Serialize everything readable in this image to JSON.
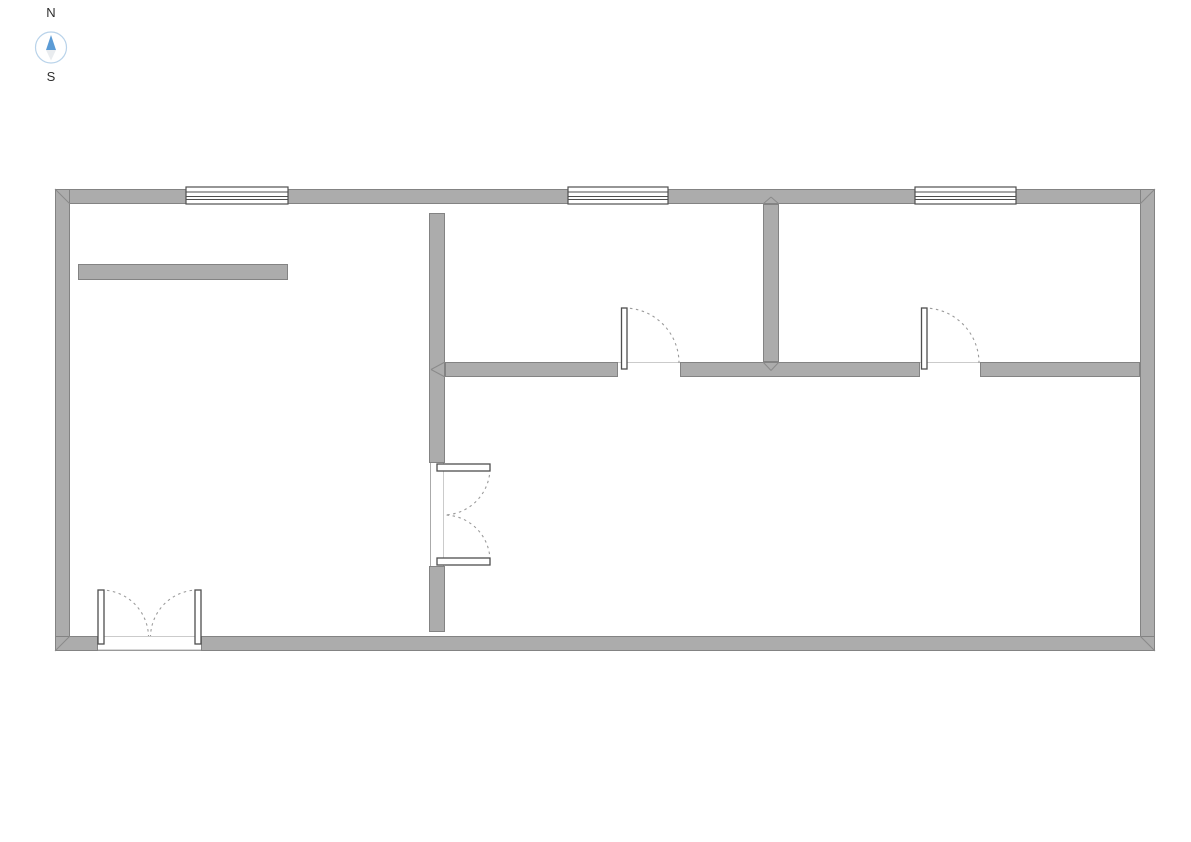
{
  "compass": {
    "north_label": "N",
    "south_label": "S",
    "circle_color": "#b9d3ea",
    "needle_north_color": "#5b9bd5",
    "needle_south_color": "#e9ecef",
    "label_color": "#2d2d2d"
  },
  "palette": {
    "background": "#ffffff",
    "wall_fill": "#acacac",
    "wall_edge": "#838383",
    "miter_line": "#8a8a8a",
    "window_stroke": "#4f4f4f",
    "door_leaf_fill": "#ffffff",
    "door_leaf_stroke": "#4f4f4f",
    "arc_color": "#9b9b9b",
    "hairline": "#cbcbcb",
    "threshold": "#999999",
    "frame_line": "#aaaaaa"
  },
  "plan": {
    "canvas": {
      "width": 1191,
      "height": 842
    },
    "walls": [
      {
        "name": "outer-wall-top",
        "x": 55,
        "y": 189,
        "w": 1100,
        "h": 15
      },
      {
        "name": "outer-wall-left",
        "x": 55,
        "y": 189,
        "w": 15,
        "h": 462
      },
      {
        "name": "outer-wall-right",
        "x": 1140,
        "y": 189,
        "w": 15,
        "h": 462
      },
      {
        "name": "outer-wall-bottom-west",
        "x": 55,
        "y": 636,
        "w": 43,
        "h": 15
      },
      {
        "name": "outer-wall-bottom-east",
        "x": 201,
        "y": 636,
        "w": 954,
        "h": 15
      },
      {
        "name": "partition-vertical-upper",
        "x": 429,
        "y": 213,
        "w": 16,
        "h": 250
      },
      {
        "name": "partition-vertical-lower",
        "x": 429,
        "y": 566,
        "w": 16,
        "h": 66
      },
      {
        "name": "partition-vertical-topright",
        "x": 763,
        "y": 204,
        "w": 16,
        "h": 158
      },
      {
        "name": "partition-horizontal-west",
        "x": 445,
        "y": 362,
        "w": 173,
        "h": 15
      },
      {
        "name": "partition-horizontal-middle",
        "x": 680,
        "y": 362,
        "w": 240,
        "h": 15
      },
      {
        "name": "partition-horizontal-east",
        "x": 980,
        "y": 362,
        "w": 160,
        "h": 15
      },
      {
        "name": "freestanding-wall-bar",
        "x": 78,
        "y": 264,
        "w": 210,
        "h": 16
      }
    ],
    "windows": [
      {
        "name": "window-top-left",
        "x": 186,
        "y": 187,
        "w": 102,
        "h": 17,
        "lines": [
          5,
          9.5,
          12.5
        ]
      },
      {
        "name": "window-top-middle",
        "x": 568,
        "y": 187,
        "w": 100,
        "h": 17,
        "lines": [
          5,
          9.5,
          12.5
        ]
      },
      {
        "name": "window-top-right",
        "x": 915,
        "y": 187,
        "w": 101,
        "h": 17,
        "lines": [
          5,
          9.5,
          12.5
        ]
      }
    ],
    "doors": [
      {
        "name": "door-room-west",
        "leaves": [
          {
            "x": 621.5,
            "y": 308,
            "w": 5.5,
            "h": 61
          }
        ],
        "arcs": [
          {
            "sx": 624,
            "sy": 308,
            "r": 55,
            "ex": 679,
            "ey": 363,
            "sweep": 1
          }
        ]
      },
      {
        "name": "door-room-east",
        "leaves": [
          {
            "x": 921.5,
            "y": 308,
            "w": 5.5,
            "h": 61
          }
        ],
        "arcs": [
          {
            "sx": 924,
            "sy": 308,
            "r": 55,
            "ex": 979,
            "ey": 363,
            "sweep": 1
          }
        ]
      },
      {
        "name": "double-door-partition",
        "leaves": [
          {
            "x": 437,
            "y": 464,
            "w": 53,
            "h": 7
          },
          {
            "x": 437,
            "y": 558,
            "w": 53,
            "h": 7
          }
        ],
        "arcs": [
          {
            "sx": 490,
            "sy": 469,
            "r": 47,
            "ex": 444,
            "ey": 515,
            "sweep": 1
          },
          {
            "sx": 490,
            "sy": 560,
            "r": 46,
            "ex": 444,
            "ey": 515,
            "sweep": 0
          }
        ]
      },
      {
        "name": "double-door-entry",
        "leaves": [
          {
            "x": 98,
            "y": 590,
            "w": 6,
            "h": 54
          },
          {
            "x": 195,
            "y": 590,
            "w": 6,
            "h": 54
          }
        ],
        "arcs": [
          {
            "sx": 101,
            "sy": 590,
            "r": 47.5,
            "ex": 148.5,
            "ey": 636,
            "sweep": 1
          },
          {
            "sx": 198,
            "sy": 590,
            "r": 47.5,
            "ex": 150.5,
            "ey": 636,
            "sweep": 0
          }
        ]
      }
    ],
    "hairlines": [
      {
        "x1": 618,
        "y1": 362.5,
        "x2": 680,
        "y2": 362.5
      },
      {
        "x1": 920,
        "y1": 362.5,
        "x2": 980,
        "y2": 362.5
      },
      {
        "x1": 443.5,
        "y1": 463,
        "x2": 443.5,
        "y2": 566
      },
      {
        "x1": 98,
        "y1": 636.5,
        "x2": 201,
        "y2": 636.5
      }
    ],
    "frame_lines": [
      {
        "x1": 430.5,
        "y1": 463,
        "x2": 430.5,
        "y2": 566
      }
    ],
    "thresholds": [
      {
        "x1": 98,
        "y1": 650.3,
        "x2": 201,
        "y2": 650.3
      }
    ],
    "miters": [
      {
        "x1": 55,
        "y1": 189,
        "x2": 70,
        "y2": 204
      },
      {
        "x1": 1155,
        "y1": 189,
        "x2": 1140,
        "y2": 204
      },
      {
        "x1": 1155,
        "y1": 651,
        "x2": 1140,
        "y2": 636
      },
      {
        "x1": 55,
        "y1": 651,
        "x2": 70,
        "y2": 636
      },
      {
        "x1": 445,
        "y1": 362,
        "x2": 431,
        "y2": 369.5
      },
      {
        "x1": 445,
        "y1": 377,
        "x2": 431,
        "y2": 369.5
      },
      {
        "x1": 763,
        "y1": 362,
        "x2": 771,
        "y2": 370.5
      },
      {
        "x1": 779,
        "y1": 362,
        "x2": 771,
        "y2": 370.5
      },
      {
        "x1": 763,
        "y1": 204,
        "x2": 771,
        "y2": 197
      },
      {
        "x1": 779,
        "y1": 204,
        "x2": 771,
        "y2": 197
      }
    ]
  }
}
